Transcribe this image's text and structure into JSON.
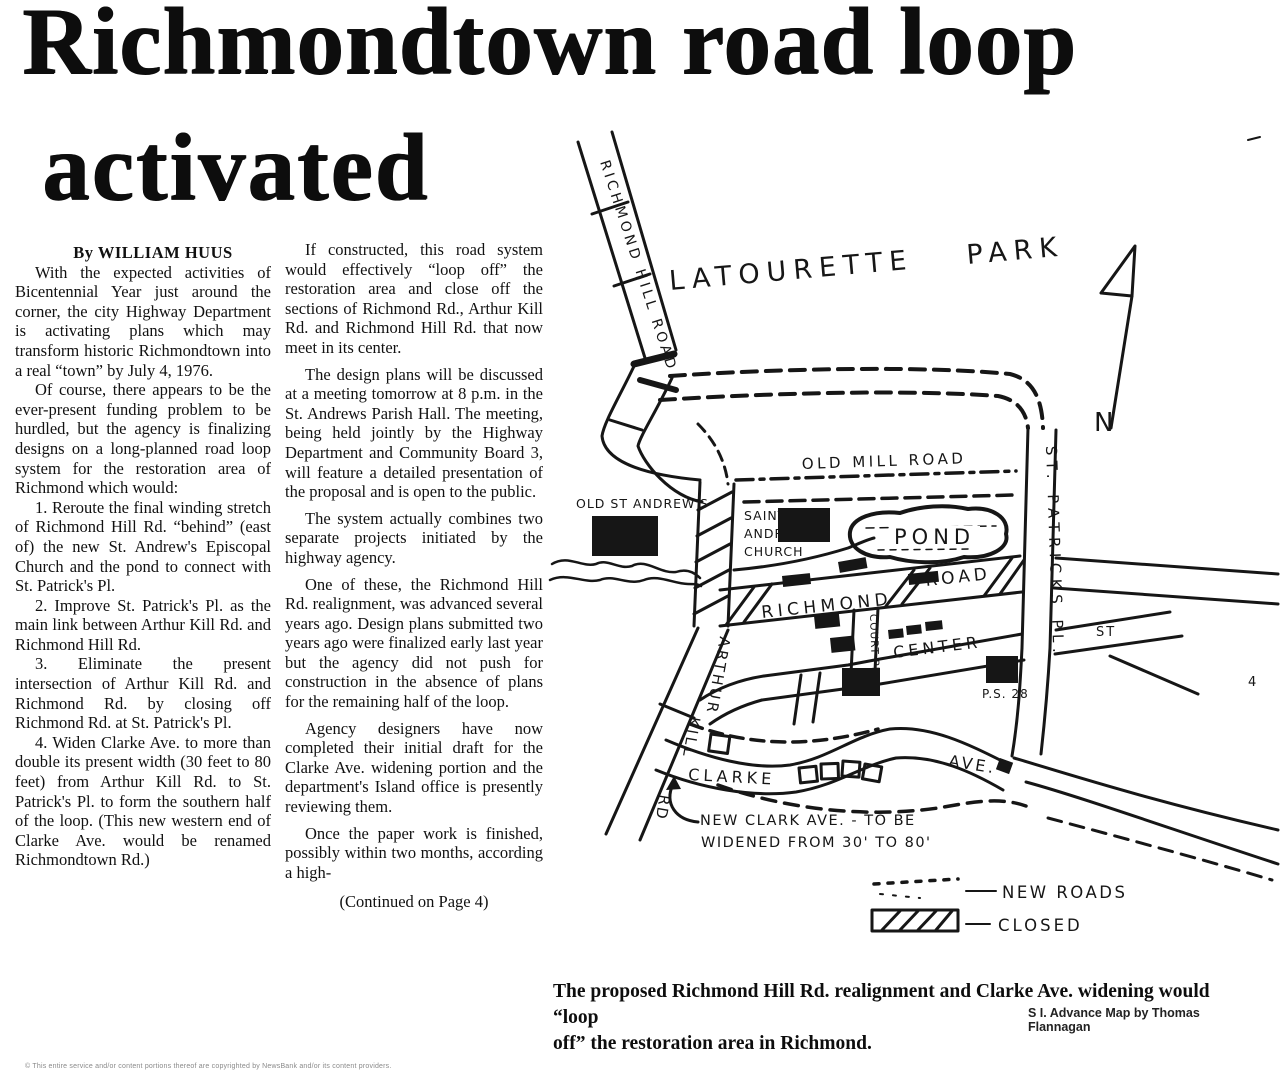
{
  "article": {
    "headline_line1": "Richmondtown road loop",
    "headline_line2": "activated",
    "byline": "By WILLIAM HUUS",
    "col1_paragraphs": [
      "With the expected activities of Bicentennial Year just around the corner, the city Highway Department is activating plans which may transform historic Richmondtown into a real “town” by July 4, 1976.",
      "Of course, there appears to be the ever-present funding problem to be hurdled, but the agency is finalizing designs on a long-planned road loop system for the restoration area of Richmond which would:",
      "1. Reroute the final winding stretch of Richmond Hill Rd. “behind” (east of) the new St. Andrew's Episcopal Church and the pond to connect with St. Patrick's Pl.",
      "2. Improve St. Patrick's Pl. as the main link between Arthur Kill Rd. and Richmond Hill Rd.",
      "3. Eliminate the present intersection of Arthur Kill Rd. and Richmond Rd. by closing off Richmond Rd. at St. Patrick's Pl.",
      "4. Widen Clarke Ave. to more than double its present width (30 feet to 80 feet) from Arthur Kill Rd. to St. Patrick's Pl. to form the southern half of the loop. (This new western end of Clarke Ave. would be renamed Richmondtown Rd.)"
    ],
    "col2_paragraphs": [
      "If constructed, this road system would effectively “loop off” the restoration area and close off the sections of Richmond Rd., Arthur Kill Rd. and Richmond Hill Rd. that now meet in its center.",
      "The design plans will be discussed at a meeting tomorrow at 8 p.m. in the St. Andrews Parish Hall. The meeting, being held jointly by the Highway Department and Community Board 3, will feature a detailed presentation of the proposal and is open to the public.",
      "The system actually combines two separate projects initiated by the highway agency.",
      "One of these, the Richmond Hill Rd. realignment, was advanced several years ago. Design plans submitted two years ago were finalized early last year but the agency did not push for construction in the absence of plans for the remaining half of the loop.",
      "Agency designers have now completed their initial draft for the Clarke Ave. widening portion and the department's Island office is presently reviewing them.",
      "Once the paper work is finished, possibly within two months, according a high-"
    ],
    "continued": "(Continued on Page 4)",
    "caption_line1": "The proposed Richmond Hill Rd. realignment and Clarke Ave. widening would “loop",
    "caption_line2": "off” the restoration area in Richmond.",
    "credit": "S I. Advance Map by Thomas Flannagan",
    "copyright": "© This entire service and/or content portions thereof are copyrighted by NewsBank and/or its content providers."
  },
  "map": {
    "park_label": "LATOURETTE PARK",
    "compass": "N",
    "roads": {
      "richmond_hill": "RICHMOND HILL ROAD",
      "old_mill": "OLD MILL ROAD",
      "richmond": "RICHMOND",
      "road": "ROAD",
      "court_pl": "COURT PL.",
      "center": "CENTER",
      "st_patricks": "ST. PATRICKS PL.",
      "st": "ST",
      "arthur": "ARTHUR",
      "kill": "KILL",
      "rd": "RD",
      "clarke": "CLARKE",
      "ave": "AVE."
    },
    "places": {
      "old_st_andrews": "OLD ST ANDREW'S",
      "saint": "SAINT",
      "andrew": "ANDREW",
      "church": "CHURCH",
      "pond": "POND",
      "ps28": "P.S. 28"
    },
    "annotation": {
      "line1": "NEW CLARK AVE. - TO BE",
      "line2": "WIDENED FROM 30' TO 80'"
    },
    "legend": {
      "new_roads": "NEW ROADS",
      "closed": "CLOSED"
    },
    "stray": "4"
  }
}
